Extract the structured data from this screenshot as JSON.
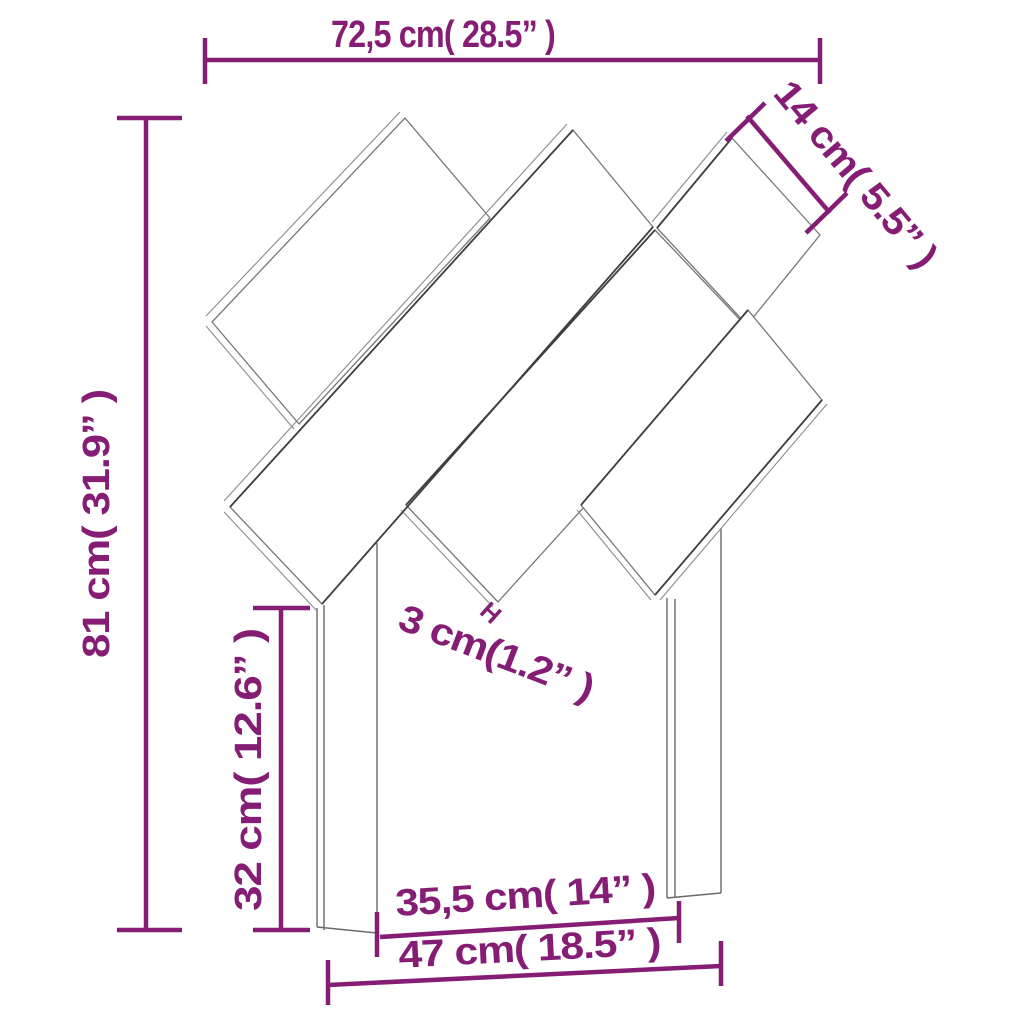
{
  "diagram": {
    "kind": "furniture-dimension-line-drawing",
    "colors": {
      "dimension": "#861D75",
      "outline": "#777777",
      "outline_dark": "#3F3F3F",
      "thickness_edge": "#8C8C8C",
      "background": "#FFFFFF"
    },
    "dimensions": {
      "overall_width": {
        "label": "72,5 cm( 28.5” )",
        "cm": "72,5",
        "inch": "28.5"
      },
      "board_width": {
        "label": "14 cm( 5.5” )",
        "cm": "14",
        "inch": "5.5"
      },
      "overall_height": {
        "label": "81 cm( 31.9” )",
        "cm": "81",
        "inch": "31.9"
      },
      "board_thickness": {
        "label": "3 cm(1.2” )",
        "cm": "3",
        "inch": "1.2",
        "tick_mark": "H"
      },
      "leg_height": {
        "label": "32 cm( 12.6” )",
        "cm": "32",
        "inch": "12.6"
      },
      "inner_width": {
        "label": "35,5 cm( 14” )",
        "cm": "35,5",
        "inch": "14"
      },
      "outer_width": {
        "label": "47 cm( 18.5” )",
        "cm": "47",
        "inch": "18.5"
      }
    }
  }
}
